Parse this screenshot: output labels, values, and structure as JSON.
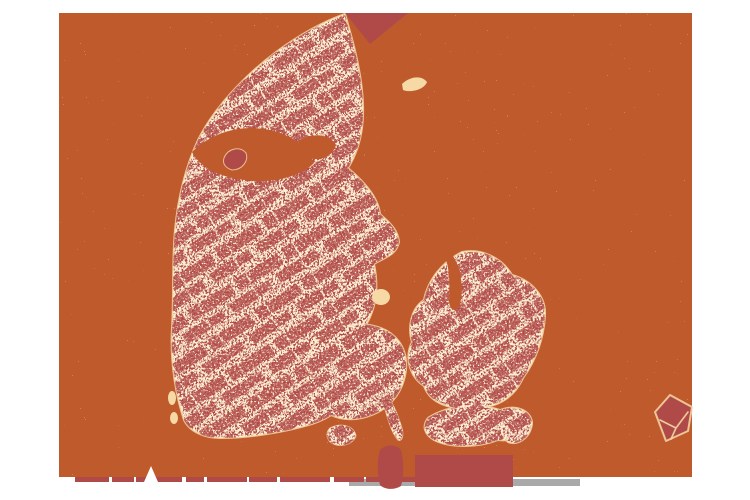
{
  "canvas": {
    "width": 750,
    "height": 500,
    "background": "#ffffff"
  },
  "map": {
    "kind": "speckled land-texture map of Denmark",
    "frame": {
      "x": 59,
      "y": 13,
      "width": 633,
      "height": 464
    },
    "regions": [
      "skagen-wedge",
      "jutland",
      "limfjord",
      "mors",
      "laeso",
      "samso",
      "funen",
      "langeland",
      "zealand",
      "isefjord-inlet",
      "lolland",
      "falster",
      "als",
      "bornholm",
      "west-coast-islets",
      "south-coast-strip",
      "south-coast-blocks",
      "gray-bar"
    ]
  },
  "colors": {
    "background": "#ffffff",
    "sea": "#bf5a2d",
    "land": "#b04a48",
    "speckle": "#f6d9a4",
    "gray_bar": "#a9a9a9"
  }
}
